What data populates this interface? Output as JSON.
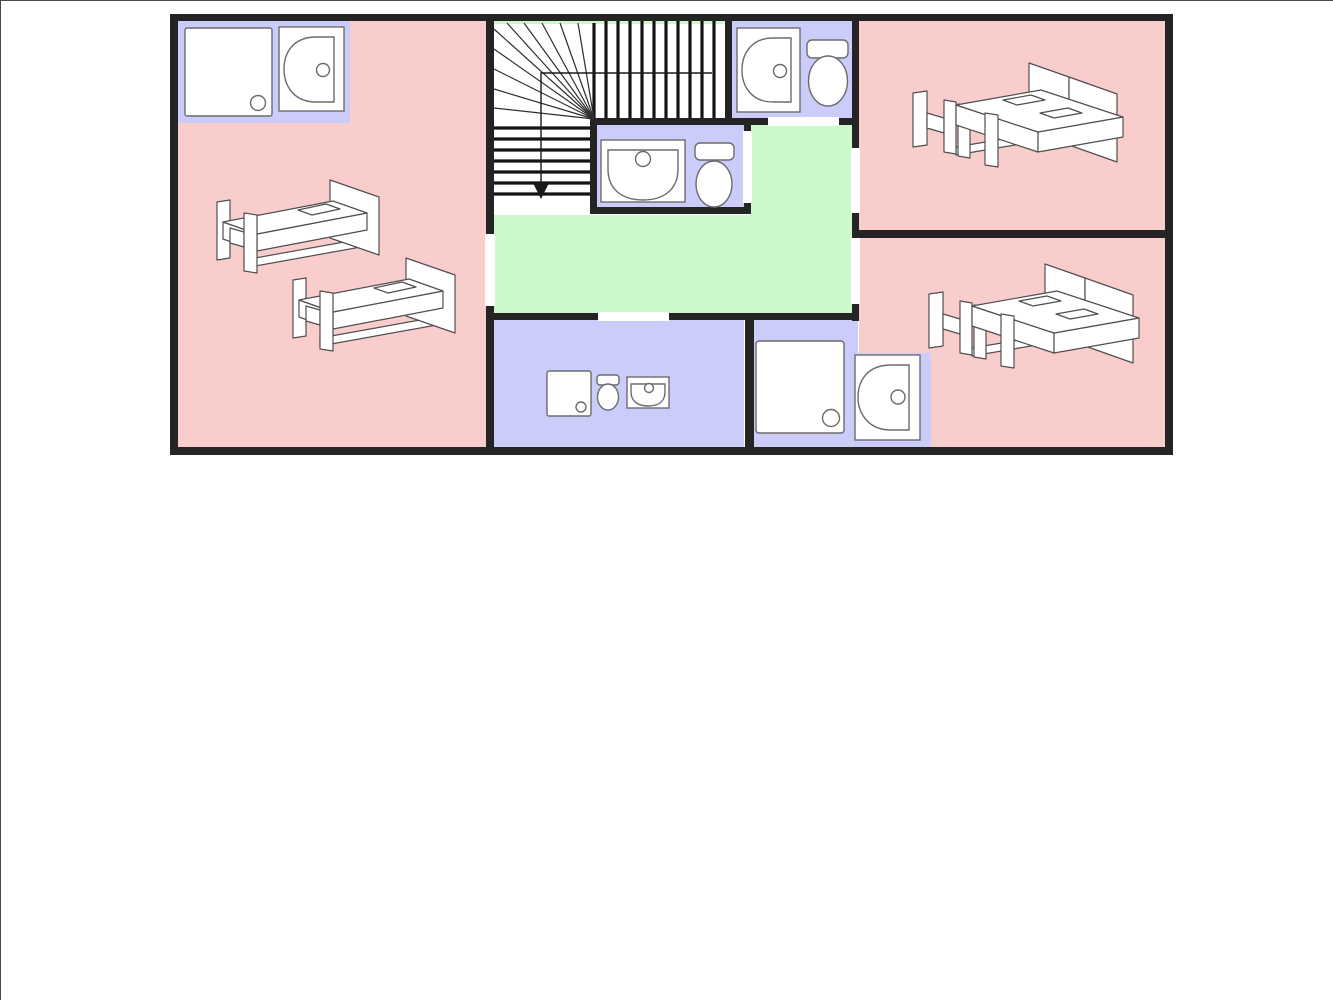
{
  "colors": {
    "wall": "#242424",
    "tread": "#141414",
    "fan_line": "#2e2e2e",
    "arrow": "#1a1a1a",
    "bedroom": "#facdcd",
    "bathroom": "#ccccfa",
    "hallway": "#ccf9cc",
    "stairwell": "#ffffff",
    "opening": "#ffffff",
    "fixture_fill": "#ffffff",
    "fixture_stroke": "#6b6b6b",
    "furniture_fill": "#ffffff",
    "furniture_stroke": "#4f4f4f",
    "frame_border": "#4a4a4a",
    "background": "#ffffff"
  },
  "floor_plan": {
    "description_of_visible_content": "Upper-floor plan: three pink bedrooms, four lavender bath/shower areas, green landing hallway, central staircase with winders and down arrow",
    "rooms": [
      {
        "id": "bedroom-left",
        "type": "bedroom",
        "fill": "bedroom",
        "furniture": [
          "single bed",
          "single bed"
        ],
        "ensuite_fixtures": [
          "shower tray",
          "washbasin"
        ]
      },
      {
        "id": "bedroom-top-right",
        "type": "bedroom",
        "fill": "bedroom",
        "furniture": [
          "double bed"
        ]
      },
      {
        "id": "bedroom-bottom-right",
        "type": "bedroom",
        "fill": "bedroom",
        "furniture": [
          "double bed"
        ],
        "ensuite_fixtures": [
          "washbasin"
        ]
      },
      {
        "id": "bathroom-top",
        "type": "bathroom",
        "fill": "bathroom",
        "fixtures": [
          "washbasin",
          "toilet"
        ]
      },
      {
        "id": "bathroom-middle",
        "type": "bathroom",
        "fill": "bathroom",
        "fixtures": [
          "washbasin",
          "toilet"
        ]
      },
      {
        "id": "bathroom-bottom-center",
        "type": "bathroom",
        "fill": "bathroom",
        "fixtures": [
          "shower tray",
          "toilet",
          "washbasin"
        ]
      },
      {
        "id": "bathroom-bottom-right",
        "type": "shower-room",
        "fill": "bathroom",
        "fixtures": [
          "shower tray",
          "washbasin"
        ]
      },
      {
        "id": "hallway-landing",
        "type": "hallway",
        "fill": "hallway"
      },
      {
        "id": "staircase",
        "type": "stairs",
        "upper_flight_treads": 10,
        "lower_flight_treads": 7,
        "winder_fan_lines": 10,
        "direction_arrow": "down"
      }
    ],
    "door_openings_count": 7,
    "fixture_totals": {
      "single_beds": 2,
      "double_beds": 2,
      "shower_trays": 3,
      "washbasins": 5,
      "toilets": 3
    }
  }
}
